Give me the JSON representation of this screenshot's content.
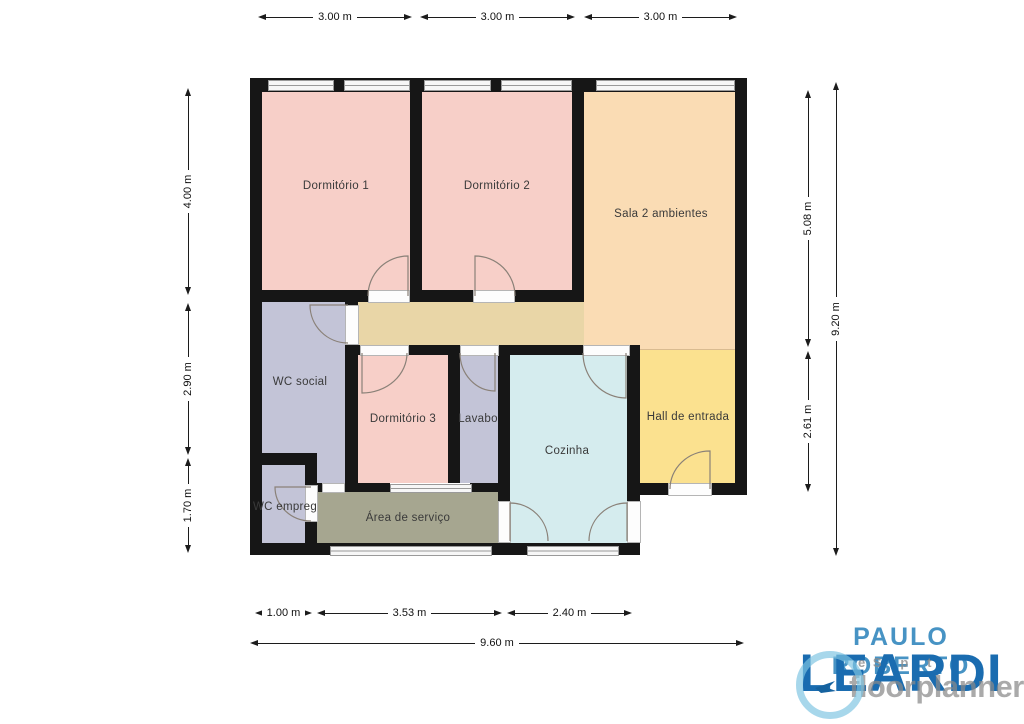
{
  "plan": {
    "wall_color": "#161616",
    "rooms": [
      {
        "name": "dormitorio-1",
        "label": "Dormitório 1",
        "color": "#f7cfc8"
      },
      {
        "name": "dormitorio-2",
        "label": "Dormitório 2",
        "color": "#f7cfc8"
      },
      {
        "name": "sala",
        "label": "Sala 2 ambientes",
        "color": "#fadcb4"
      },
      {
        "name": "wc-social",
        "label": "WC social",
        "color": "#c3c4d7"
      },
      {
        "name": "dormitorio-3",
        "label": "Dormitório 3",
        "color": "#f7cfc8"
      },
      {
        "name": "lavabo",
        "label": "Lavabo",
        "color": "#c3c4d7"
      },
      {
        "name": "cozinha",
        "label": "Cozinha",
        "color": "#d5ecee"
      },
      {
        "name": "hall",
        "label": "Hall de entrada",
        "color": "#fbe18f"
      },
      {
        "name": "wc-empregada",
        "label": "WC empreg",
        "color": "#c3c4d7"
      },
      {
        "name": "area-servico",
        "label": "Área de serviço",
        "color": "#a6a690"
      },
      {
        "name": "corredor",
        "label": "",
        "color": "#e9d6a7"
      }
    ],
    "dimensions": {
      "top": [
        "3.00 m",
        "3.00 m",
        "3.00 m"
      ],
      "left": [
        "4.00 m",
        "2.90 m",
        "1.70 m"
      ],
      "right_inner": [
        "5.08 m",
        "2.61 m"
      ],
      "right_total": "9.20 m",
      "bottom": [
        "1.00 m",
        "3.53 m",
        "2.40 m"
      ],
      "bottom_total": "9.60 m"
    }
  },
  "branding": {
    "name_line1": "PAULO ROBERTO",
    "name_line2": "LEARDI",
    "name_color1": "#4793c4",
    "name_color2": "#1a6cb0",
    "watermark_text": "floorplanner",
    "watermark_fragments": "e S   p   t",
    "watermark_color": "#8a8a8a"
  }
}
